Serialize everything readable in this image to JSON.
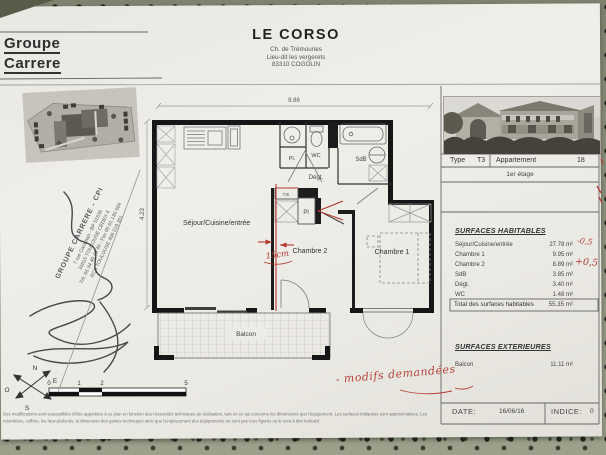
{
  "colors": {
    "accent_red": "#b23a32",
    "paper": "#edebe6",
    "fabric": "#8f9480",
    "ink": "#2f2f2f"
  },
  "header": {
    "logo1": "Groupe",
    "logo2": "Carrere",
    "project": "LE CORSO",
    "address1": "Ch. de Trémouries",
    "address2": "Lieu-dit les vergerets",
    "address3": "83310 COGOLIN"
  },
  "stamp": {
    "line1": "GROUPE CARRERE - CPI",
    "line2": "7 rue Caraman - BP 51536",
    "line3": "31015 TOULOUSE CEDEX 6",
    "line4": "Tél. 05 34 40 40 40 - Fax 05 61 130 504",
    "line5": "RCS TOULOUSE 408 219 351"
  },
  "plan": {
    "dim_width": "9.86",
    "dim_height": "4.23",
    "sejour": "Séjour/Cuisine/entrée",
    "chambre2": "Chambre 2",
    "chambre1": "Chambre 1",
    "wc": "WC",
    "sdb": "SdB",
    "degt": "Dégt.",
    "pl_dot": "Pl.",
    "pl": "Pl",
    "te": "T.E",
    "balcon": "Balcon",
    "note_15cm": "15cm",
    "note_modifs": "- modifs demandées",
    "scale": {
      "t0": "0",
      "t1": "1",
      "t2": "2",
      "t5": "5"
    },
    "compass": {
      "n": "N",
      "e": "E",
      "s": "S",
      "o": "O"
    }
  },
  "panel": {
    "type_label": "Type",
    "type_value": "T3",
    "apt_label": "Appartement",
    "apt_value": "18",
    "floor": "1er étage",
    "hab_title": "SURFACES HABITABLES",
    "hab_rows": [
      {
        "label": "Séjour/Cuisine/entrée",
        "value": "27.78 m²",
        "note": "-0,5"
      },
      {
        "label": "Chambre 1",
        "value": "9.95 m²",
        "note": ""
      },
      {
        "label": "Chambre 2",
        "value": "8.89 m²",
        "note": "+0,5"
      },
      {
        "label": "SdB",
        "value": "3.85 m²",
        "note": ""
      },
      {
        "label": "Dégt.",
        "value": "3.40 m²",
        "note": ""
      },
      {
        "label": "WC",
        "value": "1.48 m²",
        "note": ""
      }
    ],
    "total_label": "Total des surfaces habitables",
    "total_value": "55.35 m²",
    "ext_title": "SURFACES EXTERIEURES",
    "ext_rows": [
      {
        "label": "Balcon",
        "value": "11.11 m²"
      }
    ],
    "date_label": "DATE:",
    "date_value": "16/06/16",
    "indice_label": "INDICE:",
    "indice_value": "0"
  },
  "footer": {
    "line1": "Des modifications sont susceptibles d'être apportées à ce plan en fonction des nécessités techniques de réalisation, tant en ce qui concerne les dimensions que l'équipement. Les surfaces indiquées sont approximatives. Les",
    "line2": "retombées, coffres, les faux-plafonds, la dimension des gaines techniques ainsi que l'emplacement des équipements ne sont pas tous figurés ou le sont à titre indicatif."
  }
}
